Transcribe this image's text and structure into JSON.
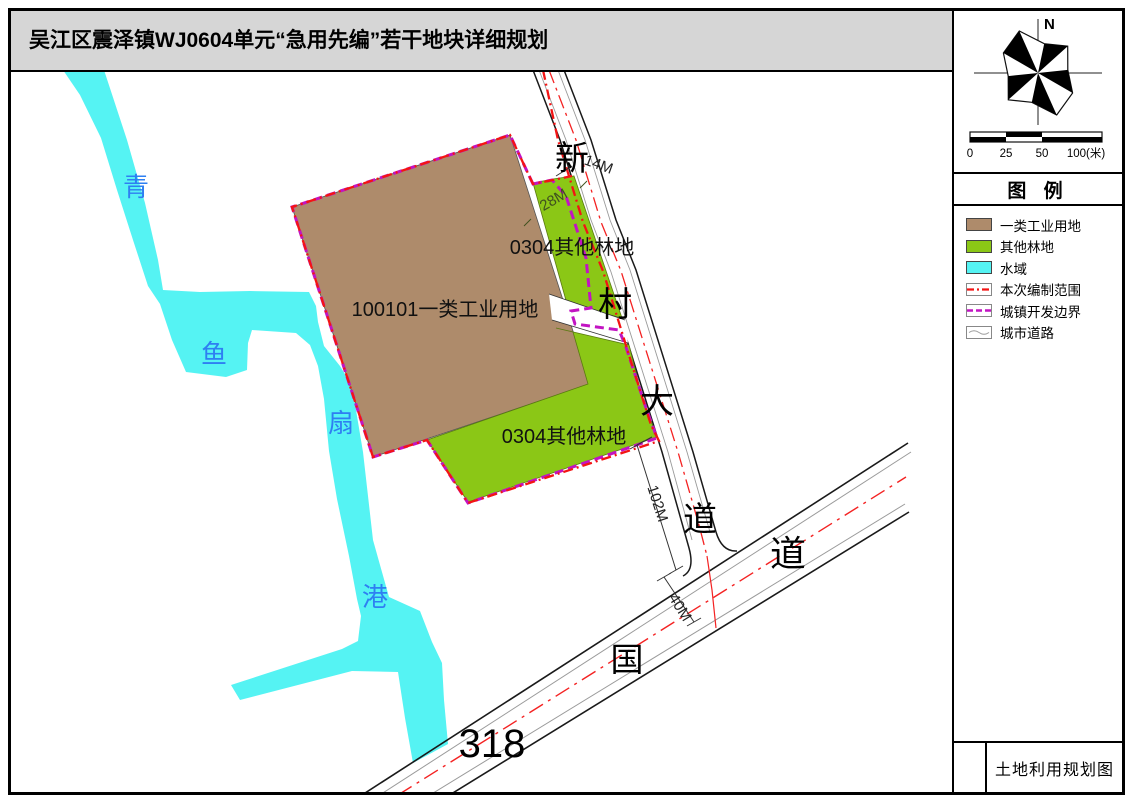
{
  "window": {
    "title": "吴江区震泽镇WJ0604单元“急用先编”若干地块详细规划"
  },
  "compass": {
    "north_label": "N"
  },
  "scale_bar": {
    "tick_labels": [
      "0",
      "25",
      "50",
      "100(米)"
    ]
  },
  "legend": {
    "header": "图 例",
    "items": [
      {
        "label": "一类工业用地",
        "swatch": "fill",
        "color": "#AE8B6B"
      },
      {
        "label": "其他林地",
        "swatch": "fill",
        "color": "#8BC716"
      },
      {
        "label": "水域",
        "swatch": "fill",
        "color": "#55F3F3"
      },
      {
        "label": "本次编制范围",
        "swatch": "dashdot-line",
        "color": "#F31414"
      },
      {
        "label": "城镇开发边界",
        "swatch": "dashed-line",
        "color": "#C214C2"
      },
      {
        "label": "城市道路",
        "swatch": "road-symbol",
        "color": "#9A9A9A"
      }
    ]
  },
  "title_block": {
    "drawing_title": "土地利用规划图"
  },
  "map": {
    "parcels": {
      "industrial_label": "100101一类工业用地",
      "forest_upper_label": "0304其他林地",
      "forest_lower_label": "0304其他林地"
    },
    "river_name_chars": [
      "青",
      "鱼",
      "扇",
      "港"
    ],
    "road_xincun_chars": [
      "新",
      "村",
      "大",
      "道"
    ],
    "road_guodao": {
      "guo": "国",
      "dao": "道",
      "number": "318"
    },
    "dimensions": {
      "road_width_top": "14M",
      "green_width": "28M",
      "setback": "102M",
      "highway_width": "40M"
    },
    "colors": {
      "industrial": "#AE8B6B",
      "forest": "#8BC716",
      "water": "#55F3F3",
      "boundary_red": "#F31414",
      "boundary_magenta": "#C214C2",
      "water_label_blue": "#2E7FF2"
    }
  }
}
